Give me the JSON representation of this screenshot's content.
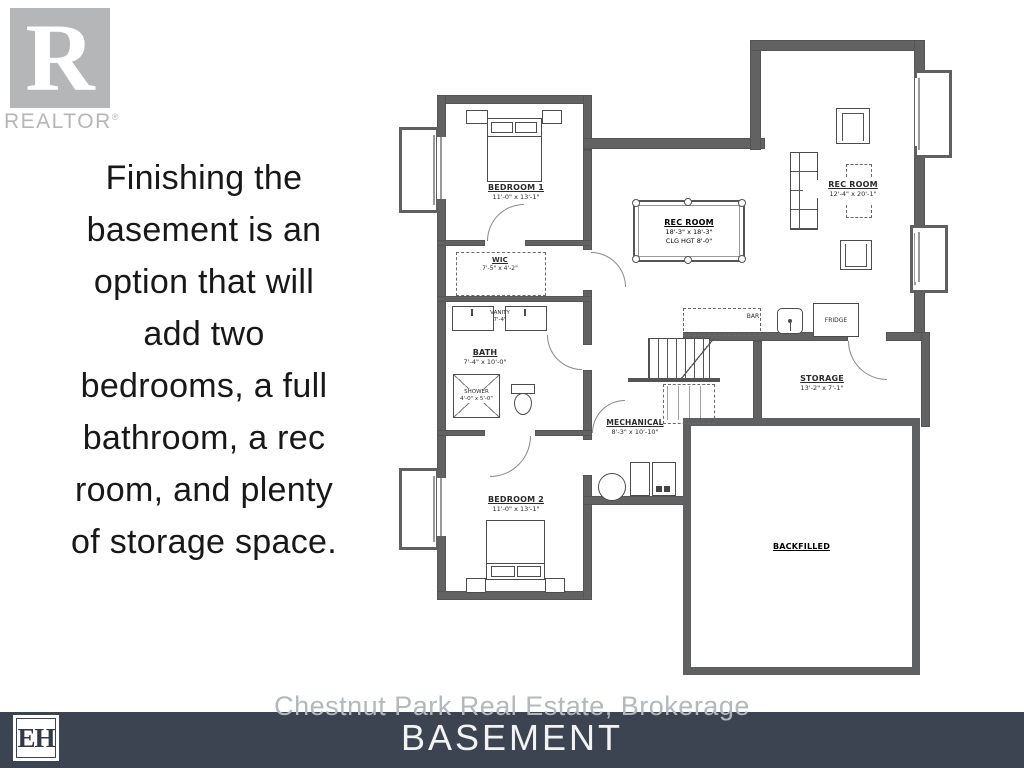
{
  "colors": {
    "wall": "#5f6062",
    "footer_bar": "#3d4451",
    "logo_gray": "#b5b6b7",
    "description_text": "#181818",
    "footer_title_text": "#f2f3f5",
    "brokerage_text": "#b2b8bf"
  },
  "realtor": {
    "letter": "R",
    "label": "REALTOR",
    "reg": "®"
  },
  "description": {
    "lines": [
      "Finishing the",
      "basement is an",
      "option that will",
      "add two",
      "bedrooms, a full",
      "bathroom, a rec",
      "room, and plenty",
      "of storage space."
    ]
  },
  "plan": {
    "bedroom1": {
      "name": "BEDROOM 1",
      "dims": "11'-0\" x 13'-1\""
    },
    "bedroom2": {
      "name": "BEDROOM 2",
      "dims": "11'-0\" x 13'-1\""
    },
    "wic": {
      "name": "WIC",
      "dims": "7'-5\" x 4'-2\""
    },
    "vanity": {
      "name": "VANITY",
      "dims": "7'-4\""
    },
    "bath": {
      "name": "BATH",
      "dims": "7'-4\" x 10'-0\""
    },
    "shower": {
      "name": "SHOWER",
      "dims": "4'-0\" x 5'-0\""
    },
    "recroom_pool": {
      "name": "REC ROOM",
      "dims": "18'-3\" x 18'-3\"",
      "ceiling": "CLG HGT 8'-0\""
    },
    "recroom_main": {
      "name": "REC ROOM",
      "dims": "12'-4\" x 20'-1\""
    },
    "bar": {
      "name": "BAR"
    },
    "fridge": {
      "name": "FRIDGE"
    },
    "storage": {
      "name": "STORAGE",
      "dims": "13'-2\" x 7'-1\""
    },
    "mechanical": {
      "name": "MECHANICAL",
      "dims": "8'-3\" x 10'-10\""
    },
    "backfilled": {
      "name": "BACKFILLED"
    }
  },
  "footer": {
    "brokerage": "Chestnut Park Real Estate, Brokerage",
    "plan_title": "BASEMENT",
    "logo": "EH"
  }
}
